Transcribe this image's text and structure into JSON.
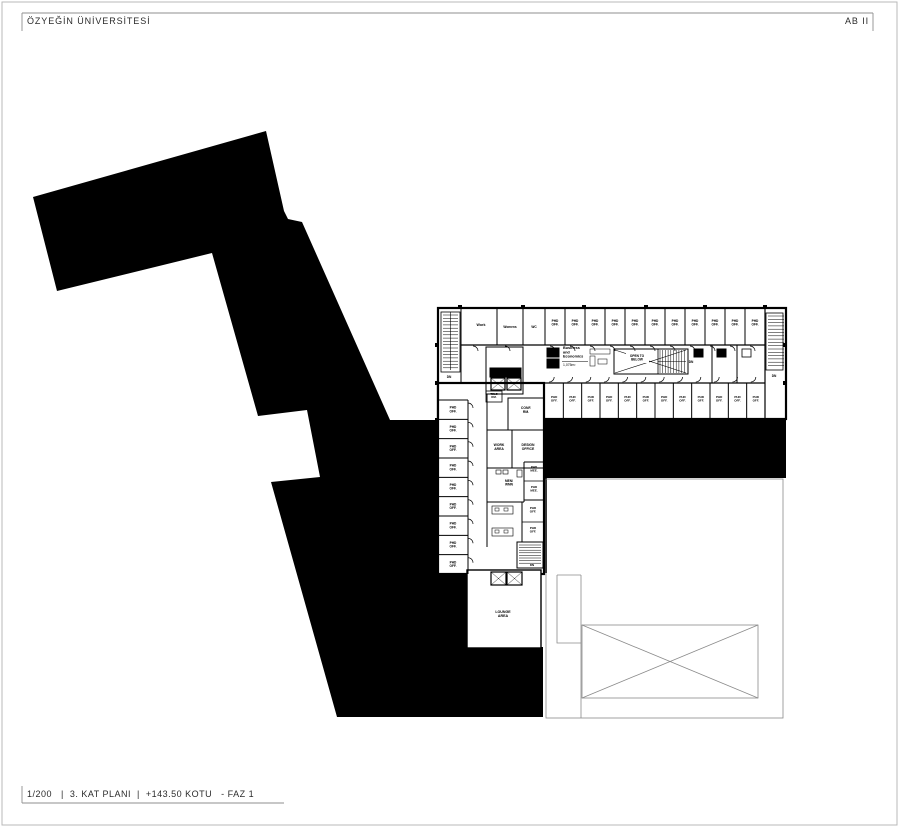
{
  "header": {
    "university": "ÖZYEĞİN ÜNİVERSİTESİ",
    "project_code": "AB II"
  },
  "footer": {
    "text": "1/200   |  3. KAT PLANI  |  +143.50 KOTU   - FAZ 1"
  },
  "plan": {
    "labels": {
      "phd_office": "PHD\nOFF.",
      "work": "Work",
      "womens": "Womens",
      "wc": "WC",
      "conf_room": "CONF.\nRM.",
      "tele_room": "TELE\nRM.",
      "work_area": "WORK\nAREA",
      "design_office": "DESIGN\nOFFICE",
      "men_wmn": "MEN/\nWMN",
      "phd_meeting": "PHD\nMEE.",
      "lounge": "LOUNGE\nAREA",
      "open_to_below": "OPEN TO\nBELOW",
      "business": "Business\nand\nEconomics",
      "business_area": "1,075m²",
      "down": "DN"
    },
    "counts": {
      "top_row_phd_offices": 11,
      "bottom_row_phd_offices": 12,
      "left_column_phd_offices": 9
    },
    "colors": {
      "built_mass": "#000000",
      "walls": "#000000",
      "light_lines": "#8a8a8a"
    }
  }
}
